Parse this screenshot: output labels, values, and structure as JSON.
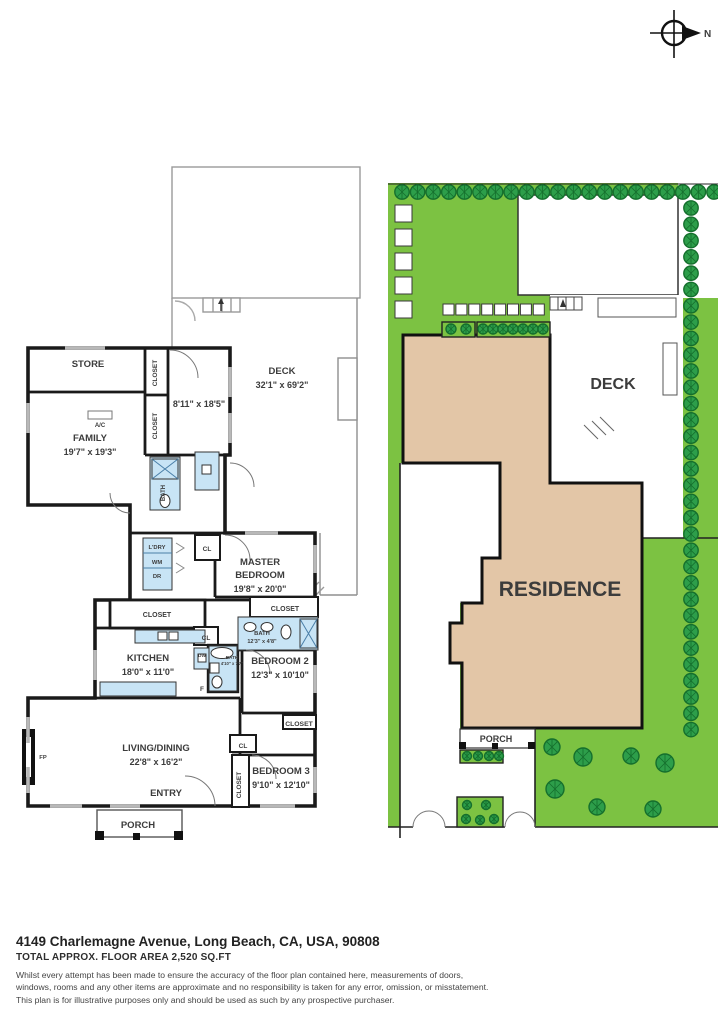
{
  "compass": {
    "north_label": "N"
  },
  "title_block": {
    "address": "4149 Charlemagne Avenue, Long Beach, CA, USA, 90808",
    "floor_area": "TOTAL APPROX. FLOOR AREA 2,520 SQ.FT",
    "disclaimer_lines": [
      "Whilst every attempt has been made to ensure the accuracy of the floor plan contained here, measurements of doors,",
      "windows, rooms and any other items are approximate and no responsibility is taken for any error, omission, or misstatement.",
      "This plan is for illustrative purposes only and should be used as such by any prospective purchaser."
    ]
  },
  "colors": {
    "lawn": "#7cc242",
    "tree": "#2d9e4a",
    "tree_outline": "#156f2d",
    "residence": "#e3c6a7",
    "fixture": "#c8e4f5",
    "wall": "#1a1a1a"
  },
  "floorplan": {
    "labels": [
      {
        "text": "STORE",
        "x": 78,
        "y": 222,
        "size": 9.5
      },
      {
        "text": "CLOSET",
        "x": 147,
        "y": 228,
        "size": 6.5,
        "rotate": -90
      },
      {
        "text": "CLOSET",
        "x": 147,
        "y": 281,
        "size": 6.5,
        "rotate": -90
      },
      {
        "text": "A/C",
        "x": 90,
        "y": 282,
        "size": 6
      },
      {
        "text": "8'11\" x 18'5\"",
        "x": 189,
        "y": 262,
        "size": 9
      },
      {
        "text": "FAMILY",
        "x": 80,
        "y": 296,
        "size": 9.5
      },
      {
        "text": "19'7\" x 19'3\"",
        "x": 80,
        "y": 310,
        "size": 9
      },
      {
        "text": "DECK",
        "x": 272,
        "y": 229,
        "size": 9.5
      },
      {
        "text": "32'1\" x 69'2\"",
        "x": 272,
        "y": 243,
        "size": 9
      },
      {
        "text": "BATH",
        "x": 155,
        "y": 348,
        "size": 6,
        "rotate": -90
      },
      {
        "text": "L'DRY",
        "x": 147,
        "y": 404,
        "size": 5.8
      },
      {
        "text": "WM",
        "x": 147,
        "y": 419,
        "size": 5.8
      },
      {
        "text": "DR",
        "x": 147,
        "y": 433,
        "size": 5.8
      },
      {
        "text": "CL",
        "x": 197,
        "y": 406,
        "size": 6.5
      },
      {
        "text": "MASTER",
        "x": 250,
        "y": 420,
        "size": 9.5
      },
      {
        "text": "BEDROOM",
        "x": 250,
        "y": 433,
        "size": 9.5
      },
      {
        "text": "19'8\" x 20'0\"",
        "x": 250,
        "y": 447,
        "size": 9
      },
      {
        "text": "CLOSET",
        "x": 275,
        "y": 466,
        "size": 7
      },
      {
        "text": "BATH",
        "x": 252,
        "y": 490,
        "size": 5.8
      },
      {
        "text": "12'3\" x 4'8\"",
        "x": 252,
        "y": 498,
        "size": 5.5
      },
      {
        "text": "CLOSET",
        "x": 147,
        "y": 472,
        "size": 7
      },
      {
        "text": "CL",
        "x": 196,
        "y": 495,
        "size": 6.5
      },
      {
        "text": "KITCHEN",
        "x": 138,
        "y": 516,
        "size": 9.5
      },
      {
        "text": "18'0\" x 11'0\"",
        "x": 138,
        "y": 530,
        "size": 9
      },
      {
        "text": "DW",
        "x": 192,
        "y": 512,
        "size": 4.8
      },
      {
        "text": "BATH",
        "x": 222,
        "y": 514,
        "size": 4.6
      },
      {
        "text": "4'10\" x 7'7\"",
        "x": 222,
        "y": 520,
        "size": 4.2
      },
      {
        "text": "F",
        "x": 192,
        "y": 546,
        "size": 6.5
      },
      {
        "text": "BEDROOM 2",
        "x": 270,
        "y": 519,
        "size": 9.5
      },
      {
        "text": "12'3\" x 10'10\"",
        "x": 270,
        "y": 533,
        "size": 9
      },
      {
        "text": "CLOSET",
        "x": 289,
        "y": 581,
        "size": 6.8
      },
      {
        "text": "FP",
        "x": 33,
        "y": 614,
        "size": 5.8
      },
      {
        "text": "LIVING/DINING",
        "x": 146,
        "y": 606,
        "size": 9.5
      },
      {
        "text": "22'8\" x 16'2\"",
        "x": 146,
        "y": 620,
        "size": 9
      },
      {
        "text": "CL",
        "x": 233,
        "y": 603,
        "size": 6.5
      },
      {
        "text": "CLOSET",
        "x": 231,
        "y": 640,
        "size": 6.5,
        "rotate": -90
      },
      {
        "text": "BEDROOM 3",
        "x": 271,
        "y": 629,
        "size": 9.5
      },
      {
        "text": "9'10\" x 12'10\"",
        "x": 271,
        "y": 643,
        "size": 9
      },
      {
        "text": "ENTRY",
        "x": 156,
        "y": 651,
        "size": 9.5
      },
      {
        "text": "PORCH",
        "x": 128,
        "y": 683,
        "size": 9.5
      }
    ]
  },
  "siteplan": {
    "labels": [
      {
        "text": "DECK",
        "x": 225,
        "y": 206,
        "size": 16
      },
      {
        "text": "RESIDENCE",
        "x": 172,
        "y": 413,
        "size": 21
      },
      {
        "text": "PORCH",
        "x": 108,
        "y": 559,
        "size": 9
      }
    ]
  }
}
